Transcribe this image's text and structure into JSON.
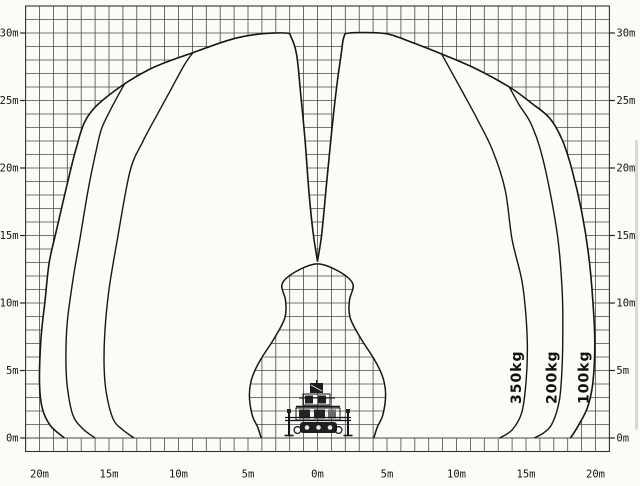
{
  "page": {
    "title": "Aerial work platform working range diagram",
    "colors": {
      "ink": "#161616",
      "grid": "#4a4a4a",
      "paper": "#fbfbf8"
    }
  },
  "chart_data": {
    "type": "area",
    "title": "Working envelope / load chart (boom lift with outriggers)",
    "xlabel": "horizontal outreach (m)",
    "ylabel": "working height (m)",
    "x_range_m": [
      -21,
      21
    ],
    "y_range_m": [
      -1,
      32
    ],
    "grid": {
      "on": true,
      "spacing_m": 1
    },
    "x_ticks": {
      "values": [
        -20,
        -15,
        -10,
        -5,
        0,
        5,
        10,
        15,
        20
      ],
      "labels": [
        "20m",
        "15m",
        "10m",
        "5m",
        "0m",
        "5m",
        "10m",
        "15m",
        "20m"
      ]
    },
    "y_ticks": {
      "values": [
        0,
        5,
        10,
        15,
        20,
        25,
        30
      ],
      "labels": [
        "0m",
        "5m",
        "10m",
        "15m",
        "20m",
        "25m",
        "30m"
      ],
      "sides": [
        "left",
        "right"
      ]
    },
    "envelope_100kg": {
      "name": "outer envelope (100kg)",
      "left": [
        [
          -18.2,
          0
        ],
        [
          -19.2,
          0.9
        ],
        [
          -19.8,
          2.2
        ],
        [
          -20.0,
          4.1
        ],
        [
          -19.9,
          7.3
        ],
        [
          -19.6,
          10.2
        ],
        [
          -19.3,
          13.0
        ],
        [
          -18.8,
          15.3
        ],
        [
          -18.1,
          18.4
        ],
        [
          -17.4,
          21.3
        ],
        [
          -16.6,
          23.7
        ],
        [
          -15.0,
          25.4
        ],
        [
          -12.1,
          27.3
        ],
        [
          -8.8,
          28.6
        ],
        [
          -6.3,
          29.5
        ],
        [
          -4.4,
          29.9
        ],
        [
          -2.3,
          30.0
        ],
        [
          -1.9,
          29.7
        ],
        [
          -1.5,
          28.4
        ],
        [
          -1.2,
          25.4
        ],
        [
          -0.9,
          22.1
        ],
        [
          -0.6,
          18.0
        ],
        [
          -0.3,
          15.1
        ],
        [
          0,
          13.1
        ]
      ],
      "right": [
        [
          0,
          13.1
        ],
        [
          0.3,
          15.1
        ],
        [
          0.65,
          18.8
        ],
        [
          1.0,
          22.5
        ],
        [
          1.4,
          26.2
        ],
        [
          1.7,
          28.4
        ],
        [
          1.9,
          29.7
        ],
        [
          2.3,
          30.0
        ],
        [
          4.5,
          30.0
        ],
        [
          5.5,
          29.8
        ],
        [
          6.8,
          29.3
        ],
        [
          8.8,
          28.5
        ],
        [
          11.3,
          27.4
        ],
        [
          13.8,
          26.0
        ],
        [
          15.4,
          24.8
        ],
        [
          16.7,
          23.7
        ],
        [
          17.6,
          22.1
        ],
        [
          18.3,
          19.9
        ],
        [
          19.0,
          16.8
        ],
        [
          19.5,
          13.6
        ],
        [
          19.8,
          10.3
        ],
        [
          19.95,
          7.0
        ],
        [
          19.8,
          4.0
        ],
        [
          19.4,
          2.2
        ],
        [
          18.7,
          0.8
        ],
        [
          18.2,
          0
        ]
      ]
    },
    "curve_200kg": {
      "name": "200kg limit curve",
      "left": [
        [
          -13.9,
          26.2
        ],
        [
          -14.7,
          24.7
        ],
        [
          -15.5,
          23.0
        ],
        [
          -15.9,
          21.4
        ],
        [
          -16.5,
          18.4
        ],
        [
          -17.1,
          14.7
        ],
        [
          -17.6,
          11.7
        ],
        [
          -18.0,
          8.6
        ],
        [
          -18.1,
          6.0
        ],
        [
          -18.0,
          3.8
        ],
        [
          -17.6,
          1.7
        ],
        [
          -16.9,
          0.7
        ],
        [
          -16.0,
          0
        ]
      ],
      "right": [
        [
          13.8,
          26.0
        ],
        [
          14.5,
          24.7
        ],
        [
          15.3,
          23.4
        ],
        [
          16.0,
          21.5
        ],
        [
          16.7,
          18.4
        ],
        [
          17.3,
          14.7
        ],
        [
          17.6,
          11.0
        ],
        [
          17.65,
          8.1
        ],
        [
          17.6,
          5.3
        ],
        [
          17.4,
          2.8
        ],
        [
          16.9,
          1.1
        ],
        [
          16.3,
          0.4
        ],
        [
          15.6,
          0
        ]
      ]
    },
    "curve_350kg": {
      "name": "350kg limit curve",
      "left": [
        [
          -9.0,
          28.5
        ],
        [
          -9.6,
          27.6
        ],
        [
          -10.5,
          25.9
        ],
        [
          -11.4,
          24.2
        ],
        [
          -12.6,
          21.9
        ],
        [
          -13.5,
          19.7
        ],
        [
          -14.4,
          14.7
        ],
        [
          -15.0,
          11.0
        ],
        [
          -15.3,
          7.8
        ],
        [
          -15.35,
          5.3
        ],
        [
          -15.2,
          3.4
        ],
        [
          -14.7,
          1.4
        ],
        [
          -14.0,
          0.6
        ],
        [
          -13.2,
          0
        ]
      ],
      "right": [
        [
          8.9,
          28.5
        ],
        [
          9.6,
          27.2
        ],
        [
          10.4,
          25.7
        ],
        [
          11.5,
          23.6
        ],
        [
          12.6,
          21.3
        ],
        [
          13.5,
          18.4
        ],
        [
          14.0,
          14.7
        ],
        [
          14.7,
          11.7
        ],
        [
          15.0,
          9.0
        ],
        [
          15.1,
          6.5
        ],
        [
          15.0,
          4.1
        ],
        [
          14.7,
          1.9
        ],
        [
          14.0,
          0.6
        ],
        [
          13.1,
          0
        ]
      ]
    },
    "inner_boundary": {
      "name": "machine clearance dome",
      "points": [
        [
          -4.05,
          0
        ],
        [
          -4.3,
          0.8
        ],
        [
          -4.7,
          1.7
        ],
        [
          -4.9,
          3.2
        ],
        [
          -4.7,
          4.5
        ],
        [
          -4.1,
          5.8
        ],
        [
          -3.1,
          7.4
        ],
        [
          -2.35,
          8.9
        ],
        [
          -2.3,
          10.2
        ],
        [
          -2.55,
          11.4
        ],
        [
          -1.6,
          12.3
        ],
        [
          0,
          12.9
        ],
        [
          1.6,
          12.3
        ],
        [
          2.55,
          11.4
        ],
        [
          2.3,
          10.2
        ],
        [
          2.35,
          8.9
        ],
        [
          3.1,
          7.4
        ],
        [
          4.1,
          5.8
        ],
        [
          4.7,
          4.5
        ],
        [
          4.9,
          3.2
        ],
        [
          4.7,
          1.7
        ],
        [
          4.3,
          0.8
        ],
        [
          4.05,
          0
        ]
      ]
    },
    "curve_labels": [
      {
        "text": "350kg",
        "x_m": 14.35,
        "y_m": 4.5,
        "rotation": -90
      },
      {
        "text": "200kg",
        "x_m": 16.9,
        "y_m": 4.5,
        "rotation": -90
      },
      {
        "text": "100kg",
        "x_m": 19.2,
        "y_m": 4.5,
        "rotation": -90
      }
    ],
    "legend_position": "rotated labels along right-hand curves",
    "machine": {
      "name": "boom-lift-with-outriggers",
      "position_m": [
        0,
        0
      ]
    }
  }
}
